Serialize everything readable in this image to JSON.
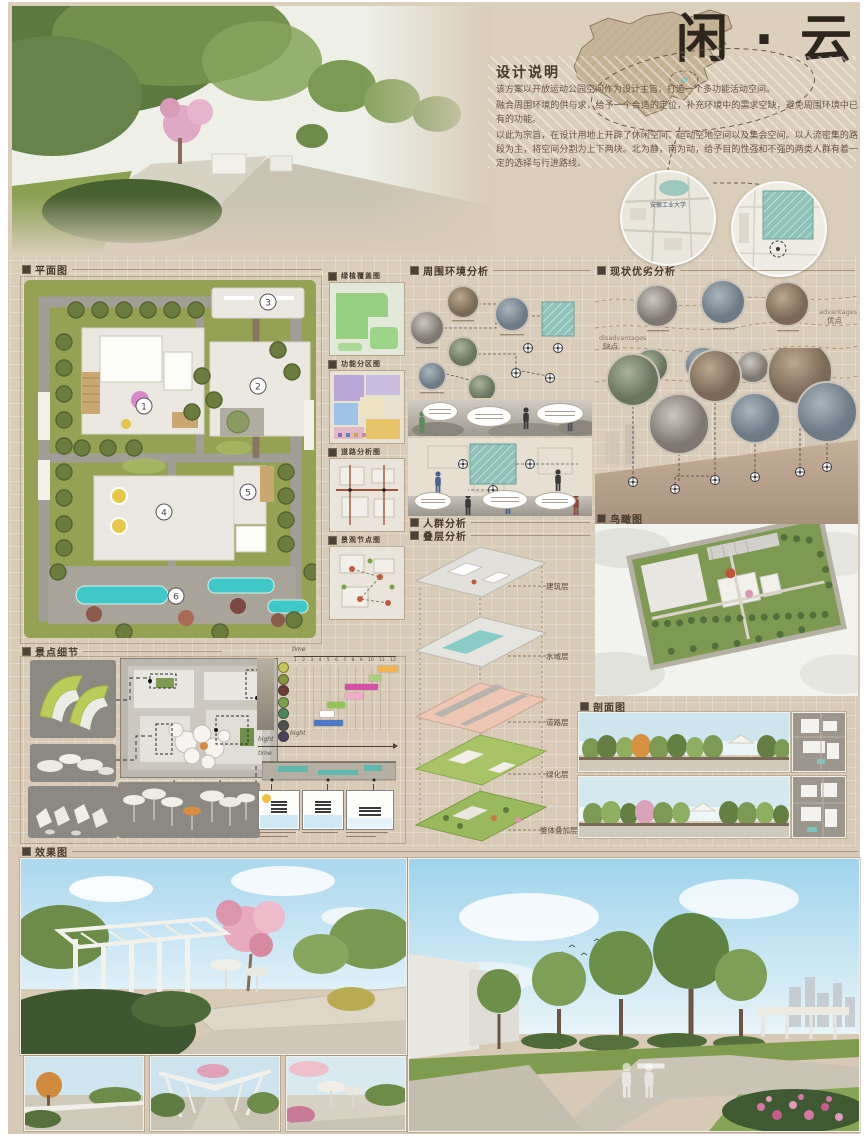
{
  "poster": {
    "title": "闲 · 云"
  },
  "header": {
    "desc_heading": "设计说明",
    "desc_p1": "该方案以开放运动公园空间作为设计主旨，打造一个多功能活动空间。",
    "desc_p2": "融合周围环境的供与求，给予一个合适的定位，补充环境中的需求空缺，避免周围环境中已有的功能。",
    "desc_p3": "以此为宗旨，在设计用地上开辟了休闲空间、运动空地空间以及集会空间。以人流密集的路段为主，将空间分割为上下两块。北为静，南为动，给予目的性强和不强的两类人群有着一定的选择与行进路线。",
    "campus_label": "安徽工业大学"
  },
  "sections": {
    "plan": {
      "title": "平面图",
      "markers": [
        "1",
        "2",
        "3",
        "4",
        "5",
        "6"
      ]
    },
    "mini_maps": [
      {
        "label": "绿植覆盖图"
      },
      {
        "label": "功能分区图"
      },
      {
        "label": "道路分析图"
      },
      {
        "label": "景观节点图"
      }
    ],
    "environment": {
      "title": "周围环境分析"
    },
    "crowd": {
      "title": "人群分析"
    },
    "layers": {
      "title": "叠层分析",
      "items": [
        "建筑层",
        "水域层",
        "道路层",
        "绿化层",
        "整体叠加层"
      ]
    },
    "swot": {
      "title": "现状优劣分析",
      "advantages_en": "advantages",
      "advantages_cn": "优点",
      "disadvantages_en": "disadvantages",
      "disadvantages_cn": "缺点"
    },
    "aerial": {
      "title": "鸟瞰图"
    },
    "profile": {
      "title": "剖面图"
    },
    "details": {
      "title": "景点细节",
      "time_label": "time",
      "height_label": "hight"
    },
    "renders": {
      "title": "效果图"
    }
  },
  "chart_data": {
    "type": "bar",
    "x_label": "time",
    "y_label": "hight",
    "x_ticks": [
      "1",
      "2",
      "3",
      "4",
      "5",
      "6",
      "7",
      "8",
      "9",
      "10",
      "11",
      "12"
    ],
    "xlim": [
      1,
      12
    ],
    "bars": [
      {
        "row": 0,
        "start": 10,
        "end": 12.2,
        "color": "#f2b44e"
      },
      {
        "row": 1,
        "start": 9,
        "end": 10.4,
        "color": "#a9d27e"
      },
      {
        "row": 2,
        "start": 6.4,
        "end": 10,
        "color": "#d650a8"
      },
      {
        "row": 3,
        "start": 6.4,
        "end": 8.4,
        "color": "#f2aacb"
      },
      {
        "row": 4,
        "start": 4.4,
        "end": 6.4,
        "color": "#93c556"
      },
      {
        "row": 5,
        "start": 3.6,
        "end": 5.2,
        "color": "#ffffff"
      },
      {
        "row": 6,
        "start": 3,
        "end": 6.2,
        "color": "#4b79c4"
      }
    ],
    "tree_colors": [
      "#c9c65a",
      "#86953f",
      "#693c38",
      "#79a34a",
      "#49855f",
      "#4f4f4f",
      "#4a4161"
    ]
  }
}
